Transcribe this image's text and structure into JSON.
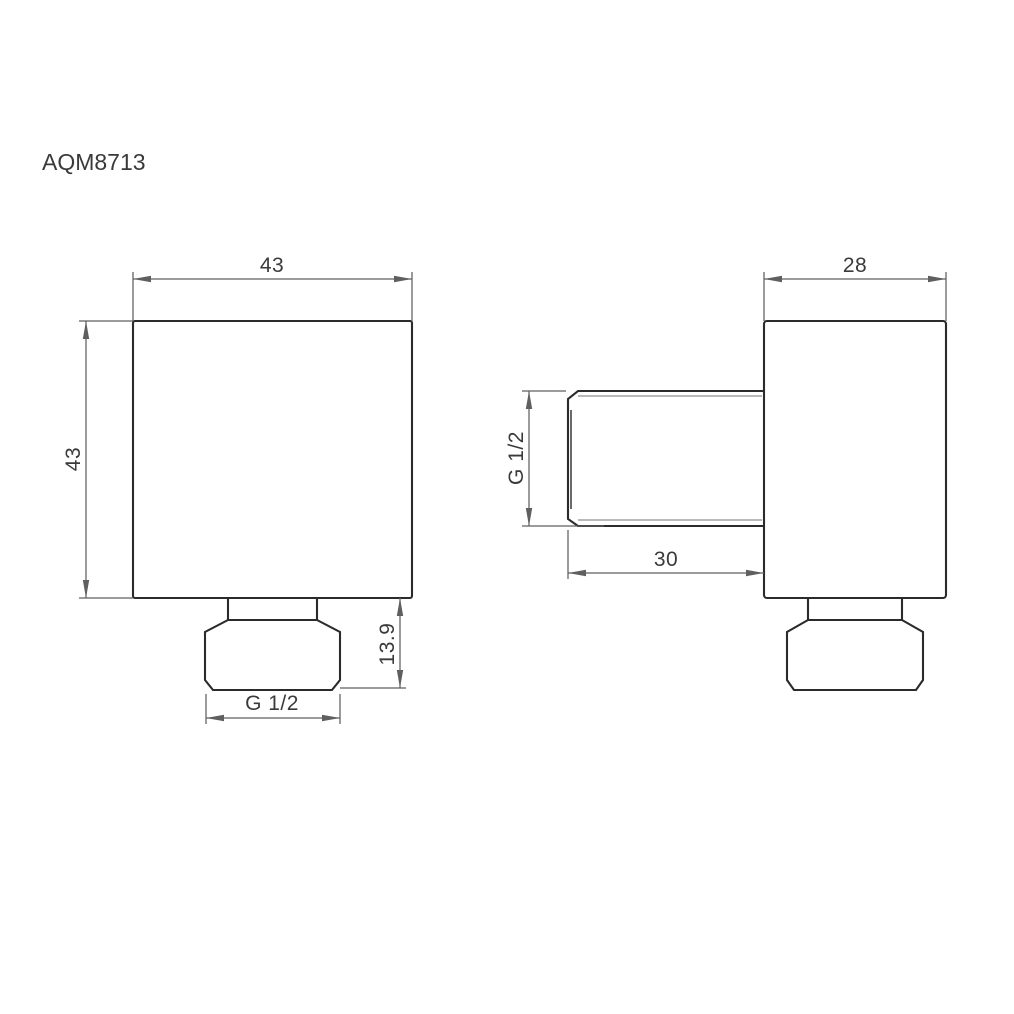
{
  "title": "AQM8713",
  "views": {
    "front": {
      "label": "front elevation of square wall outlet",
      "dim_width": "43",
      "dim_height": "43",
      "dim_nut_height": "13.9",
      "dim_thread": "G 1/2"
    },
    "side": {
      "label": "side elevation with threaded pipe spigot",
      "dim_width": "28",
      "dim_pipe_length": "30",
      "dim_thread": "G 1/2"
    }
  },
  "colors": {
    "background": "#ffffff",
    "object_line": "#2b2b2b",
    "dimension_line": "#5f5f5f",
    "thread_line": "#8f8f8f",
    "text_color": "#3a3a3a"
  }
}
